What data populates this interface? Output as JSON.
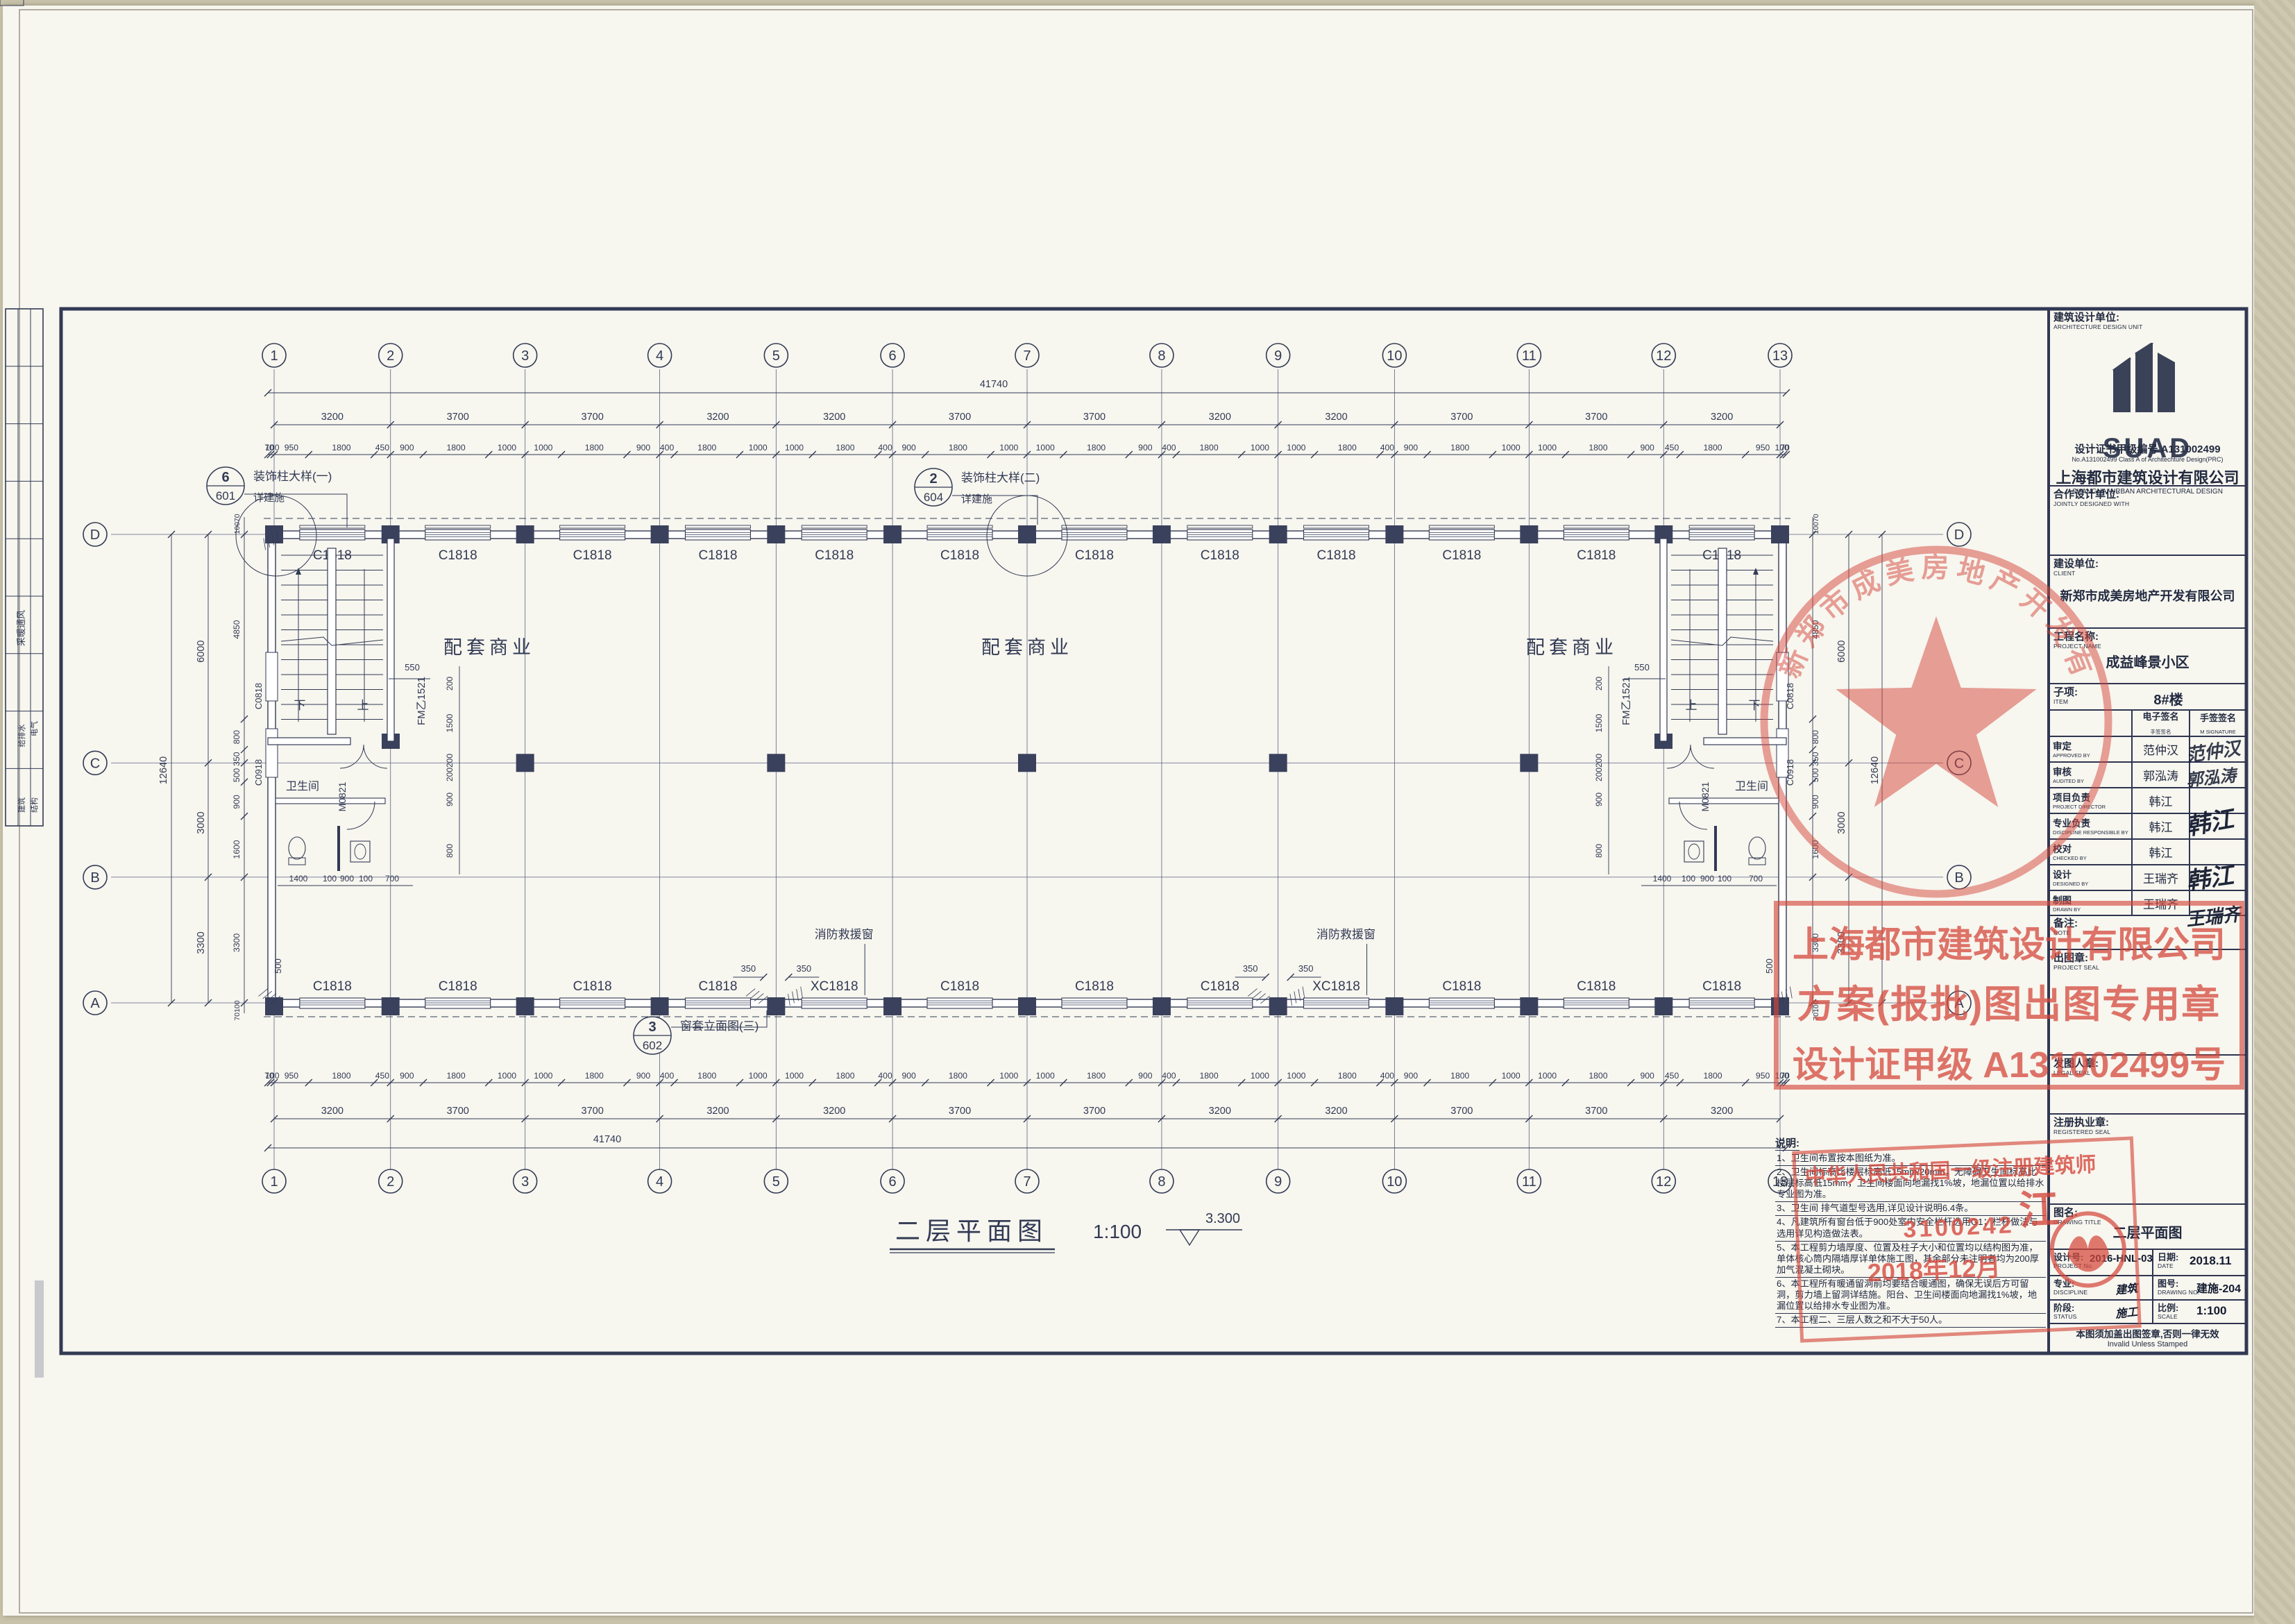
{
  "plan": {
    "col_labels": [
      "1",
      "2",
      "3",
      "4",
      "5",
      "6",
      "7",
      "8",
      "9",
      "10",
      "11",
      "12",
      "13"
    ],
    "col_spans_mm": [
      3200,
      3700,
      3700,
      3200,
      3200,
      3700,
      3700,
      3200,
      3200,
      3700,
      3700,
      3200
    ],
    "row_labels": [
      "D",
      "C",
      "B",
      "A"
    ],
    "row_spans_mm": [
      6000,
      3000,
      3300
    ],
    "row_span_labels": [
      "6000",
      "3000",
      "3300"
    ],
    "total_width": "41740",
    "total_height": "12640",
    "top_subdims": [
      "70",
      "100",
      "950",
      "1800",
      "450",
      "900",
      "1800",
      "1000",
      "1000",
      "1800",
      "900",
      "400",
      "1800",
      "1000",
      "1000",
      "1800",
      "400",
      "900",
      "1800",
      "1000",
      "1000",
      "1800",
      "900",
      "400",
      "1800",
      "1000",
      "1000",
      "1800",
      "400",
      "900",
      "1800",
      "1000",
      "1000",
      "1800",
      "900",
      "450",
      "1800",
      "950",
      "100",
      "70"
    ],
    "left_subdims": [
      "4850",
      "800",
      "350",
      "500",
      "900",
      "1600",
      "3300"
    ],
    "v_edge_top": "10070",
    "v_edge_bottom": "70100",
    "window_top_label": "C1818",
    "window_bottom_labels": [
      "C1818",
      "C1818",
      "C1818",
      "C1818",
      "XC1818",
      "C1818",
      "C1818",
      "C1818",
      "XC1818",
      "C1818",
      "C1818",
      "C1818"
    ],
    "side_windows": [
      "C0818",
      "C0918"
    ],
    "rooms": [
      "配套商业",
      "配套商业",
      "配套商业"
    ],
    "toilet": "卫生间",
    "fire_door": "FM乙1521",
    "toilet_door": "M0821",
    "stair_up": "上",
    "stair_down": "下",
    "rescue_note": "消防救援窗",
    "wing_dim": "350",
    "door_dim": "550",
    "edge_dim_500": "500",
    "stair_bottom_dims": [
      "1400",
      "100",
      "900",
      "100",
      "700"
    ],
    "interior_vchain": [
      "200",
      "1500",
      "200",
      "200",
      "900",
      "800"
    ],
    "callouts": [
      {
        "num": "6",
        "sheet": "601",
        "label": "装饰柱大样(一)",
        "sub": "详建施"
      },
      {
        "num": "2",
        "sheet": "604",
        "label": "装饰柱大样(二)",
        "sub": "详建施"
      },
      {
        "num": "3",
        "sheet": "602",
        "label": "窗套立面图(三)",
        "sub": ""
      }
    ],
    "title": "二层平面图",
    "title_scale": "1:100",
    "elevation": "3.300",
    "binding_disciplines": [
      "采暖通风",
      "给排水",
      "电气",
      "建筑",
      "结构"
    ]
  },
  "notes": {
    "heading": "说明:",
    "items": [
      "1、卫生间布置按本图纸为准。",
      "2、卫生间标高比楼层标高低15mm/20mm，无障碍卫生间标高比楼层标高低15mm，卫生间楼面向地漏找1%坡，地漏位置以给排水专业图为准。",
      "3、卫生间 排气道型号选用,详见设计说明6.4条。",
      "4、凡建筑所有窗台低于900处室内安全栏杆选用G1；栏杆做法与选用详见构造做法表。",
      "5、本工程剪力墙厚度、位置及柱子大小和位置均以结构图为准，单体核心筒内隔墙厚详单体施工图，其余部分未注明者均为200厚加气混凝土砌块。",
      "6、本工程所有暖通留洞前均要结合暖通图，确保无误后方可留洞，剪力墙上留洞详结施。阳台、卫生间楼面向地漏找1%坡，地漏位置以给排水专业图为准。",
      "7、本工程二、三层人数之和不大于50人。"
    ]
  },
  "titleblock": {
    "unit_label": "建筑设计单位:",
    "unit_en": "ARCHITECTURE DESIGN UNIT",
    "logo": "SUAD",
    "company": "上海都市建筑设计有限公司",
    "company_en": "SHANGHAI URBAN ARCHITECTURAL DESIGN",
    "cert": "设计证书甲级编号 A131002499",
    "cert_en": "No.A131002499 Class A of Architechture Design(PRC)",
    "joint_label": "合作设计单位:",
    "joint_en": "JOINTLY DESIGNED WITH",
    "client_label": "建设单位:",
    "client_en": "CLIENT",
    "client": "新郑市成美房地产开发有限公司",
    "project_label": "工程名称:",
    "project_en": "PROJECT NAME",
    "project": "成益峰景小区",
    "item_label": "子项:",
    "item_en": "ITEM",
    "item": "8#楼",
    "sig_head_e": "电子签名",
    "sig_head_e_en": "E SIGNATURE",
    "sig_head_m": "手签签名",
    "sig_head_m_en": "M SIGNATURE",
    "sig_rows": [
      {
        "label": "审定",
        "en": "APPROVED BY",
        "name": "范仲汉"
      },
      {
        "label": "审核",
        "en": "AUDITED BY",
        "name": "郭泓涛"
      },
      {
        "label": "项目负责",
        "en": "PROJECT DIRECTOR",
        "name": "韩江"
      },
      {
        "label": "专业负责",
        "en": "DISCIPLINE RESPONSIBLE BY",
        "name": "韩江"
      },
      {
        "label": "校对",
        "en": "CHECKED BY",
        "name": "韩江"
      },
      {
        "label": "设计",
        "en": "DESIGNED BY",
        "name": "王瑞齐"
      },
      {
        "label": "制图",
        "en": "DRAWN BY",
        "name": "王瑞齐"
      }
    ],
    "note_label": "备注:",
    "note_en": "NOTE",
    "seal_label": "出图章:",
    "seal_en": "PROJECT SEAL",
    "legal_label": "发图人章:",
    "legal_en": "LEGAL SEAL",
    "reg_label": "注册执业章:",
    "reg_en": "REGISTERED SEAL",
    "title_label": "图名:",
    "title_en": "DRAWING TITLE",
    "drawing_title": "二层平面图",
    "projno_label": "设计号:",
    "projno_en": "PROJECT No.",
    "projno": "2016-HNL-03",
    "date_label": "日期:",
    "date_en": "DATE",
    "date": "2018.11",
    "disc_label": "专业:",
    "disc_en": "DISCIPLINE",
    "disc": "建筑",
    "dwgno_label": "图号:",
    "dwgno_en": "DRAWING NO.",
    "dwgno": "建施-204",
    "stage_label": "阶段:",
    "stage_en": "STATUS",
    "stage": "施工",
    "scale_label": "比例:",
    "scale_en": "SCALE",
    "scale": "1:100",
    "footer": "本图须加盖出图签章,否则一律无效",
    "footer_en": "Invalid Unless Stamped"
  },
  "stamps": {
    "client_seal_ring": "新郑市成美房地产开发有限公司",
    "suad_line1": "上海都市建筑设计有限公司",
    "suad_line2": "方案(报批)图出图专用章",
    "suad_line3": "设计证甲级 A131002499号",
    "reg_line1": "中华人民共和国一级注册建筑师",
    "reg_name": "江",
    "reg_no": "3100242",
    "reg_date": "2018年12月"
  }
}
